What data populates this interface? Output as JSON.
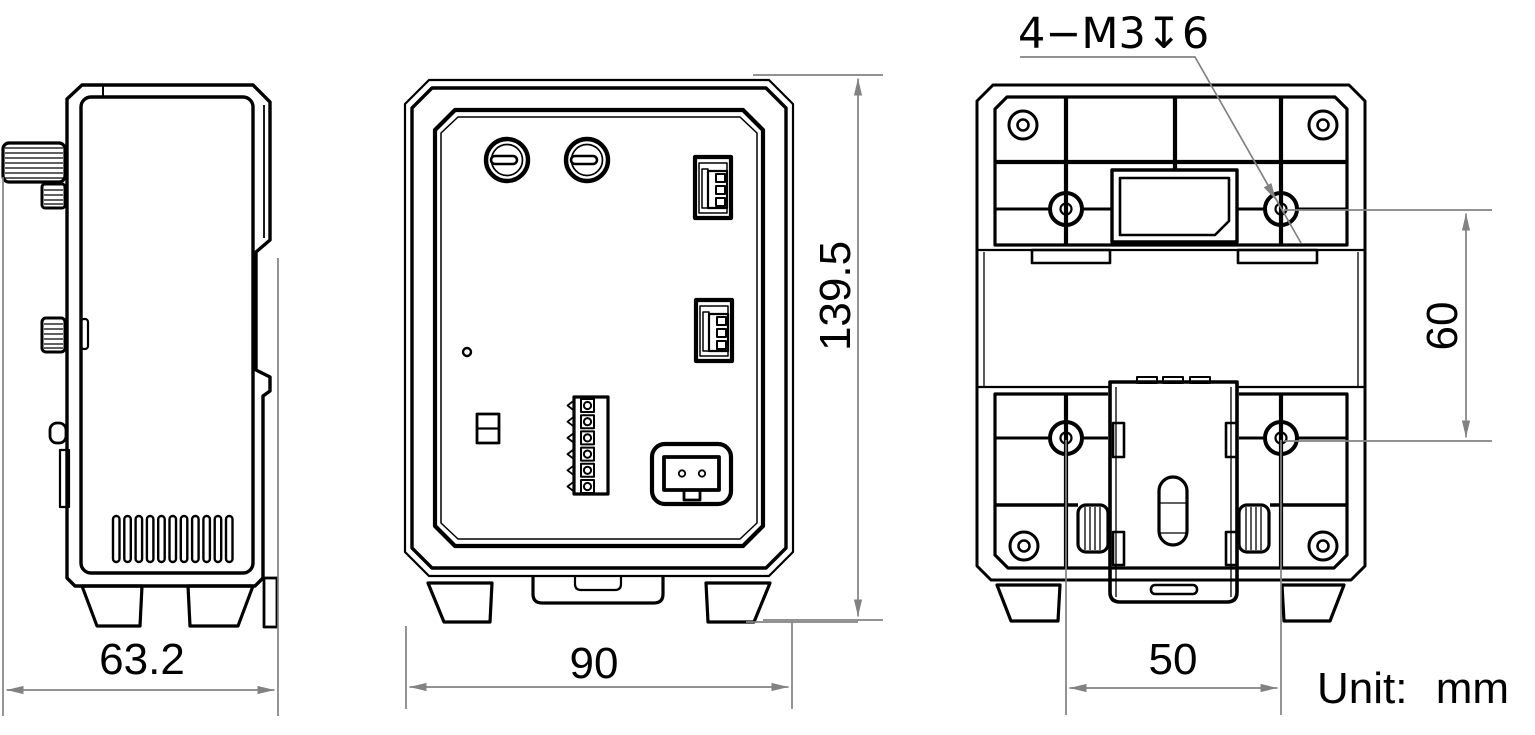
{
  "drawing": {
    "unit": {
      "prefix": "Unit:",
      "value": "mm"
    },
    "thread_callout": "4−M3↧6",
    "dimensions": {
      "side_width": "63.2",
      "front_width": "90",
      "overall_height": "139.5",
      "mount_hole_vertical_spacing": "60",
      "mount_hole_horizontal_spacing": "50"
    },
    "colors": {
      "line": "#000000",
      "dimension_line": "#828282",
      "highlight": "#a5e9e9"
    }
  }
}
